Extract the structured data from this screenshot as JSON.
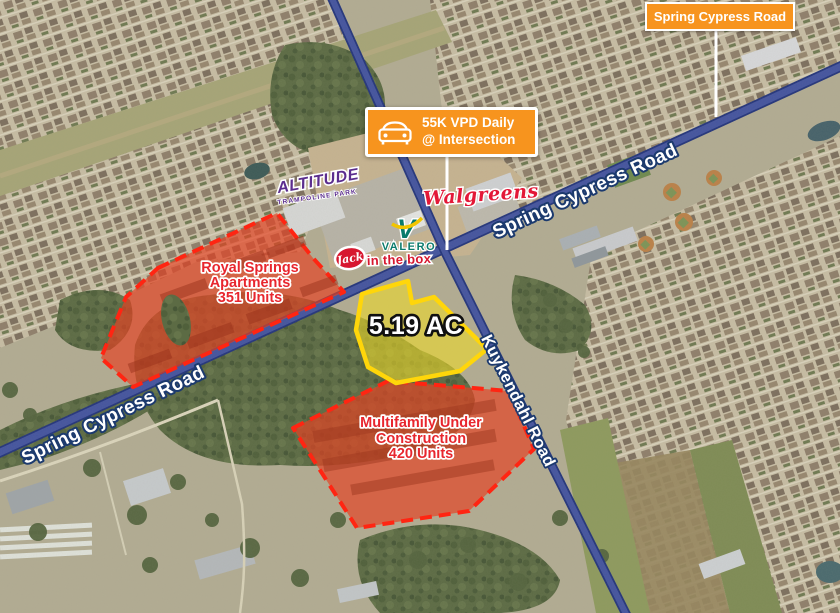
{
  "theme": {
    "accent-orange": "#F7941E",
    "parcel-red": "#FF2512",
    "parcel-red-text": "#E8262E",
    "site-yellow": "#FFD60A",
    "road-blue": "#44549F",
    "label-navy": "#1C3A6E",
    "walgreens-red": "#E31837",
    "valero-teal": "#0A7B6C",
    "jack-red": "#D7172F",
    "altitude-purple": "#5B2D8E"
  },
  "header_label": {
    "text": "Spring Cypress Road"
  },
  "traffic_callout": {
    "line1": "55K VPD Daily",
    "line2": "@ Intersection"
  },
  "road_labels": {
    "spring_cypress_upper": "Spring Cypress Road",
    "spring_cypress_lower": "Spring Cypress Road",
    "kuykendahl": "Kuykendahl Road"
  },
  "site_parcel": {
    "acreage_label": "5.19 AC"
  },
  "parcels": {
    "royal_springs": {
      "line1": "Royal Springs",
      "line2": "Apartments",
      "line3": "351 Units"
    },
    "multifamily": {
      "line1": "Multifamily Under",
      "line2": "Construction",
      "line3": "420 Units"
    }
  },
  "businesses": {
    "walgreens": "Walgreens",
    "valero_v": "V",
    "valero": "VALERO",
    "jack_script": "Jack",
    "jack_in_the_box": "in the box",
    "altitude": "ALTITUDE",
    "altitude_sub": "TRAMPOLINE PARK"
  }
}
